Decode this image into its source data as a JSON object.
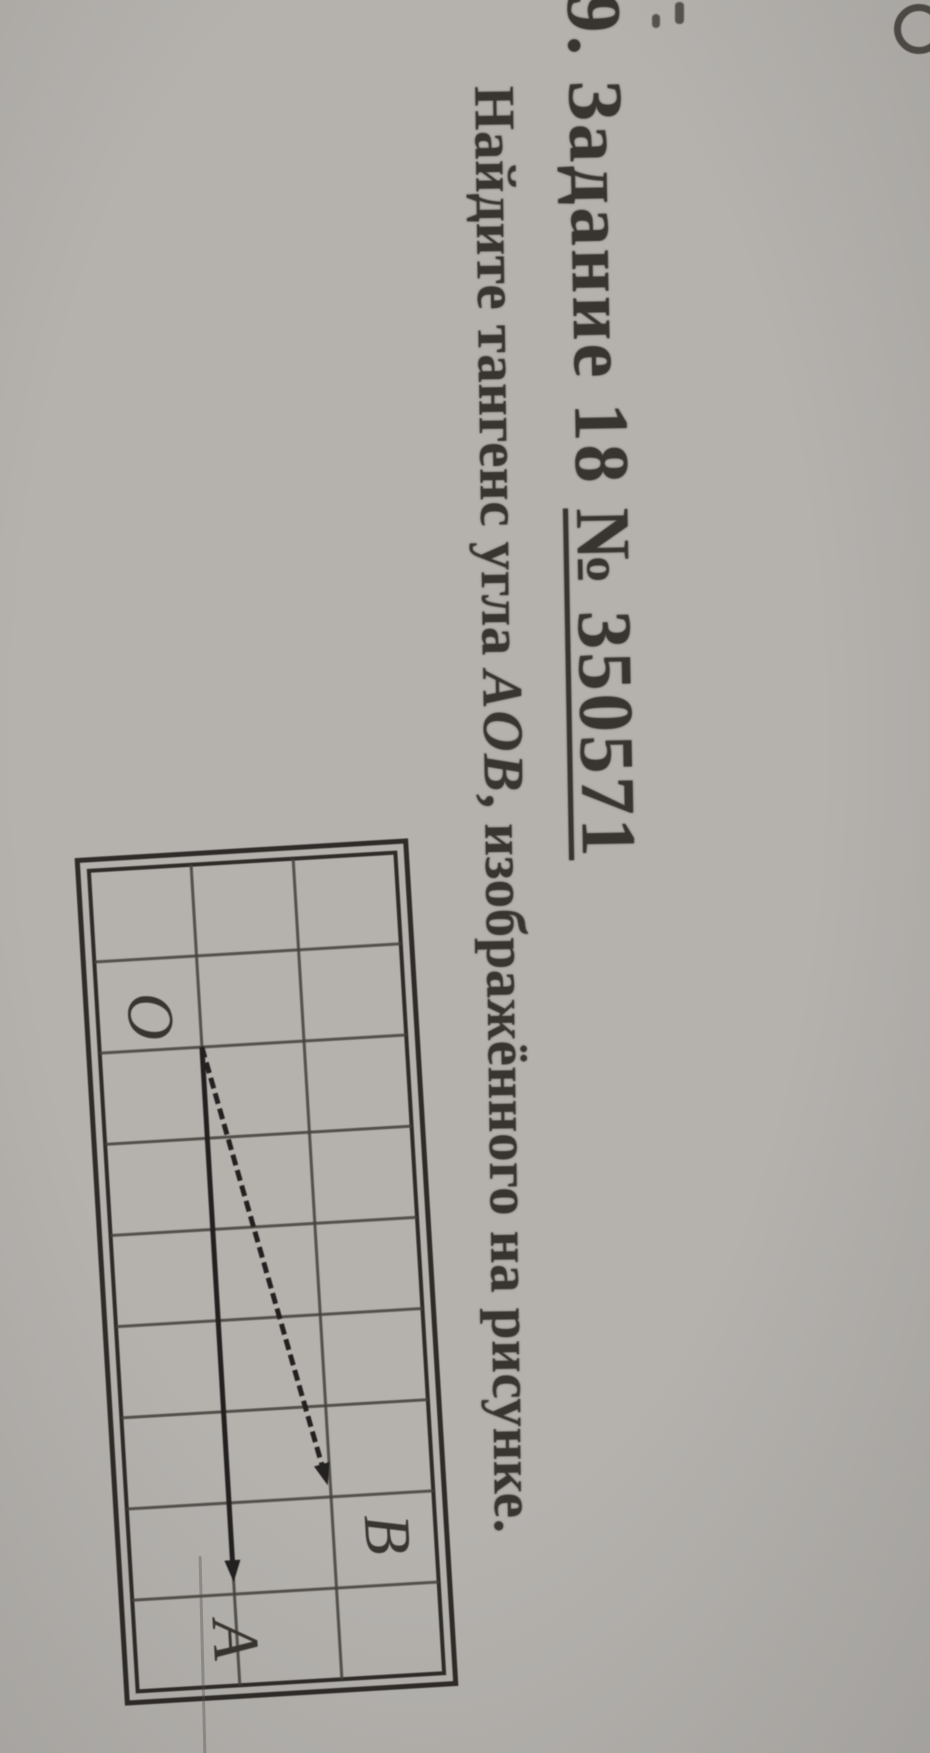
{
  "document": {
    "title": {
      "prefix": "9. Задание 18 ",
      "number": "№ 350571"
    },
    "problem": {
      "before": "Найдите тангенс угла ",
      "math": "AOB",
      "after": ", изображённого на рисунке."
    }
  },
  "figure": {
    "grid": {
      "cols": 9,
      "rows": 3
    },
    "points": {
      "O": {
        "col": 2,
        "row": 2
      },
      "B": {
        "col": 7,
        "row": 1
      },
      "A": {
        "col": 8,
        "row": 2
      }
    },
    "rays": [
      {
        "from": "O",
        "to": "B",
        "style": "dashed"
      },
      {
        "from": "O",
        "to": "A",
        "style": "solid"
      }
    ],
    "labels": [
      {
        "text": "O",
        "x": 163,
        "y": 290
      },
      {
        "text": "B",
        "x": 694,
        "y": 84
      },
      {
        "text": "A",
        "x": 790,
        "y": 242
      }
    ]
  },
  "colors": {
    "paper": "#b5b2ae",
    "ink": "#38342f",
    "grid_line": "#46423e",
    "frame": "#2e2b28",
    "ray": "#232120"
  }
}
